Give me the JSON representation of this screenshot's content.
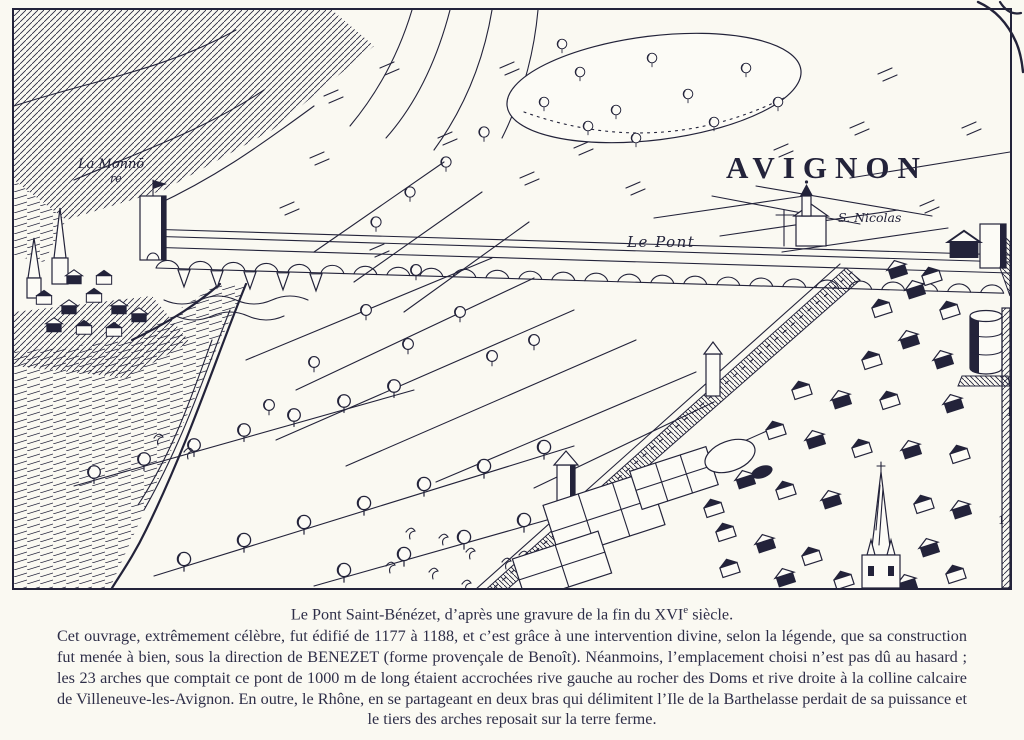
{
  "page": {
    "paper_color": "#faf9f2",
    "ink_color": "#23233a",
    "caption_ink_color": "#2e2e48"
  },
  "engraving": {
    "labels": {
      "la_monno": "La Monnō",
      "la_monno_2": "re",
      "avignon": "AVIGNON",
      "le_pont": "Le Pont",
      "s_nicolas": "S. Nicolas",
      "ref_17": "17",
      "ref_10": "1 0"
    }
  },
  "caption": {
    "title_pre": "Le Pont Saint-Bénézet, d’après une gravure de la fin du XVI",
    "title_sup": "e",
    "title_post": " siècle.",
    "body": "Cet ouvrage, extrêmement célèbre, fut édifié de 1177 à 1188, et c’est grâce à une intervention divine, selon la légende, que sa construction fut menée à bien, sous la direction de BENEZET (forme provençale de Benoît). Néanmoins, l’emplacement choisi n’est pas dû au hasard ; les 23 arches que comptait ce pont de 1000 m de long étaient accrochées rive gauche au rocher des Doms et rive droite à la colline calcaire de Villeneuve-les-Avignon. En outre, le Rhône, en se partageant en deux bras qui délimitent l’Ile de la Barthelasse perdait de sa puissance et le tiers des arches reposait sur la terre ferme."
  }
}
